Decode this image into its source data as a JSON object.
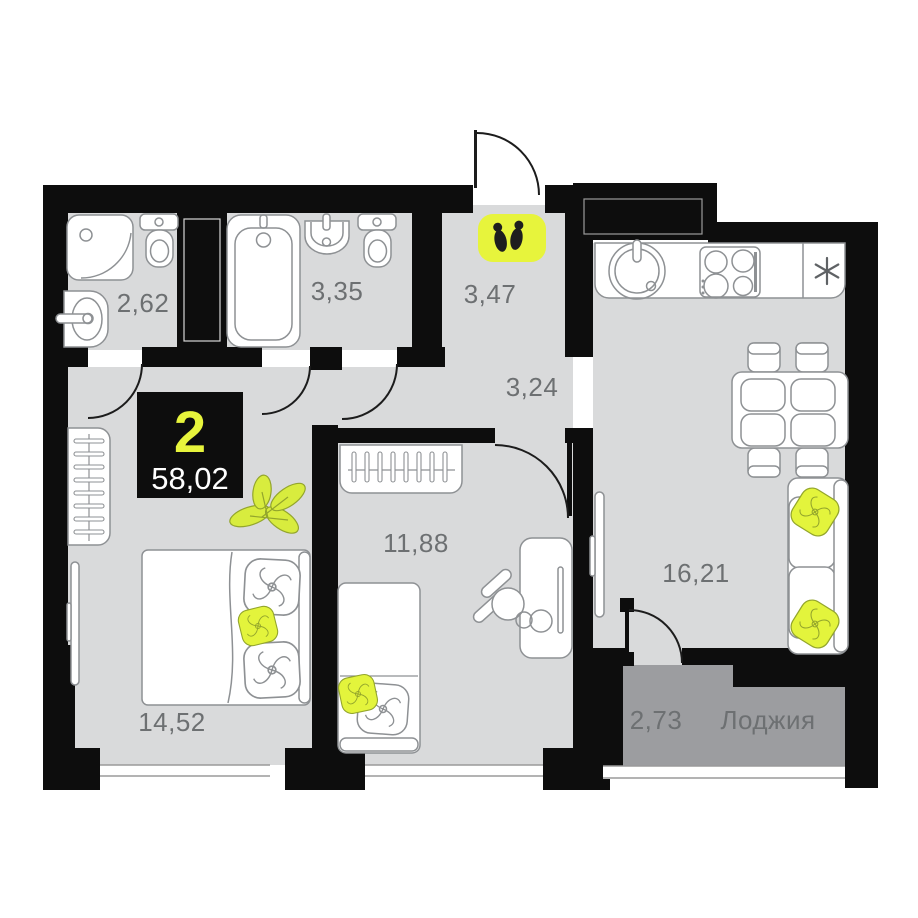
{
  "badge": {
    "rooms": "2",
    "area": "58,02"
  },
  "rooms": [
    {
      "key": "bathroom-small",
      "area": "2,62"
    },
    {
      "key": "bathroom",
      "area": "3,35"
    },
    {
      "key": "hallway",
      "area": "3,47"
    },
    {
      "key": "corridor",
      "area": "3,24"
    },
    {
      "key": "room",
      "area": "11,88"
    },
    {
      "key": "kitchen-living",
      "area": "16,21"
    },
    {
      "key": "bedroom",
      "area": "14,52"
    },
    {
      "key": "loggia",
      "area": "2,73",
      "name": "Лоджия"
    }
  ],
  "icons": {
    "entrance": "footprints-icon",
    "fridge": "asterisk-icon"
  },
  "colors": {
    "accent": "#e7f43c",
    "wall": "#0d0d0d",
    "floor": "#d9dadb",
    "loggia_floor": "#9c9da0",
    "label": "#6d7072"
  }
}
